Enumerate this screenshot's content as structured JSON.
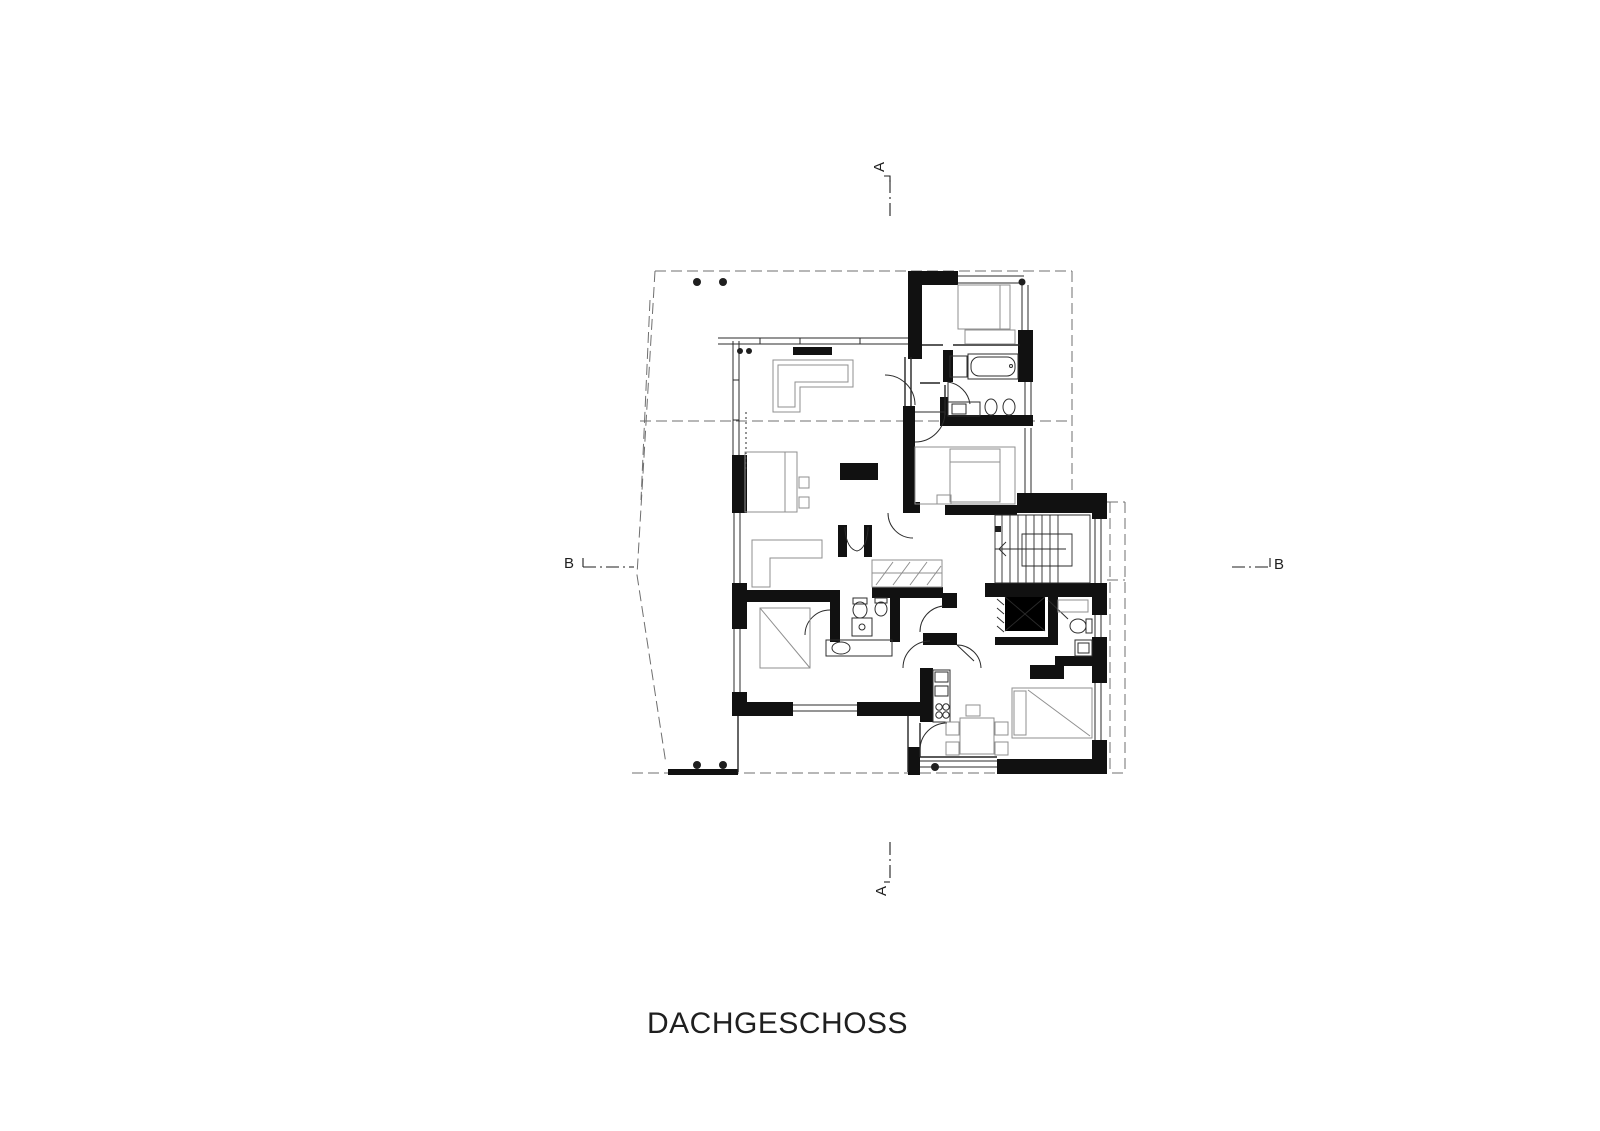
{
  "drawing": {
    "title": "DACHGESCHOSS",
    "markers": {
      "a_top": "A",
      "a_bottom": "A",
      "b_left": "B",
      "b_right": "B"
    },
    "colors": {
      "ink": "#1f1f1f",
      "wall": "#111111",
      "furniture": "#8f8f8f",
      "dashed": "#6f6f6f",
      "background": "#ffffff"
    }
  }
}
